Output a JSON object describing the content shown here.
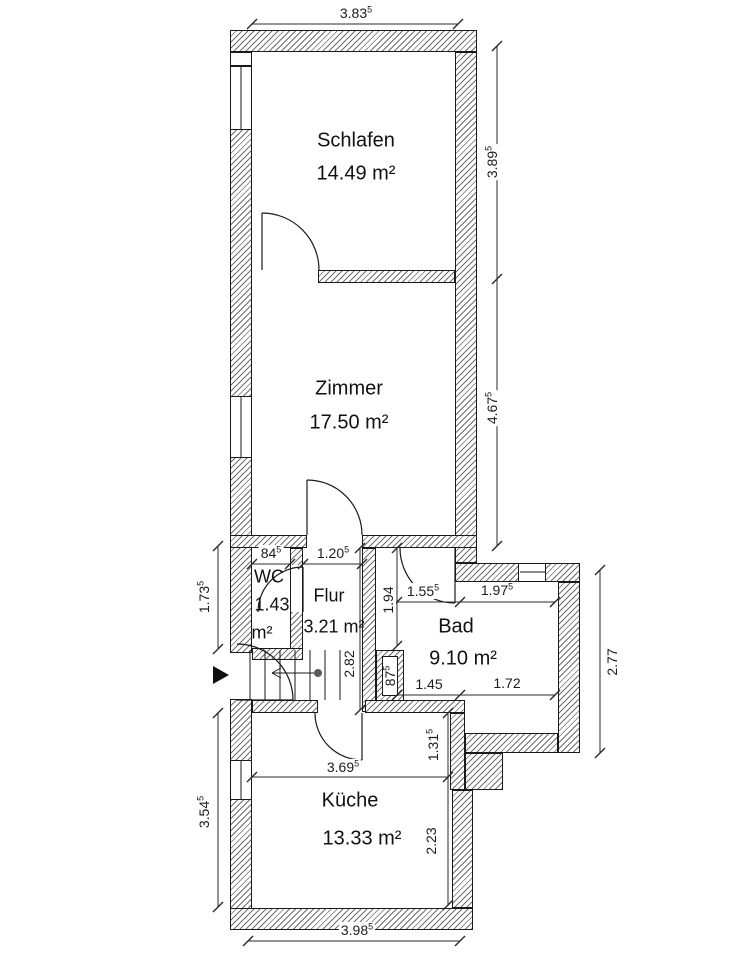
{
  "rooms": {
    "schlafen": {
      "name": "Schlafen",
      "area": "14.49 m²"
    },
    "zimmer": {
      "name": "Zimmer",
      "area": "17.50 m²"
    },
    "wc": {
      "name": "WC",
      "area_value": "1.43",
      "area_unit": "m²"
    },
    "flur": {
      "name": "Flur",
      "area": "3.21 m²"
    },
    "bad": {
      "name": "Bad",
      "area": "9.10 m²"
    },
    "kueche": {
      "name": "Küche",
      "area": "13.33 m²"
    }
  },
  "dims": {
    "top": {
      "v": "3.83",
      "s": "5"
    },
    "schlafen_right": {
      "v": "3.89",
      "s": "5"
    },
    "zimmer_right": {
      "v": "4.67",
      "s": "5"
    },
    "wc_left": {
      "v": "1.73",
      "s": "5"
    },
    "wc_width": {
      "v": "84",
      "s": "5"
    },
    "flur_width": {
      "v": "1.20",
      "s": "5"
    },
    "bad_entry": {
      "v": "1.94",
      "s": ""
    },
    "bad_top_left": {
      "v": "1.55",
      "s": "5"
    },
    "bad_top_right": {
      "v": "1.97",
      "s": "5"
    },
    "hall_height": {
      "v": "2.82",
      "s": ""
    },
    "shaft": {
      "v": "87",
      "s": "5"
    },
    "bad_bottom_left": {
      "v": "1.45",
      "s": ""
    },
    "bad_bottom_right": {
      "v": "1.72",
      "s": ""
    },
    "bad_right": {
      "v": "2.77",
      "s": ""
    },
    "step": {
      "v": "1.31",
      "s": "5"
    },
    "kueche_top": {
      "v": "3.69",
      "s": "5"
    },
    "kueche_right": {
      "v": "2.23",
      "s": ""
    },
    "kueche_left": {
      "v": "3.54",
      "s": "5"
    },
    "bottom": {
      "v": "3.98",
      "s": "5"
    }
  },
  "colors": {
    "background": "#ffffff",
    "wall_line": "#1a1a1a",
    "hatch": "#6e6e6e",
    "dimension_line": "#2b2b2b",
    "entrance_marker": "#111111"
  }
}
